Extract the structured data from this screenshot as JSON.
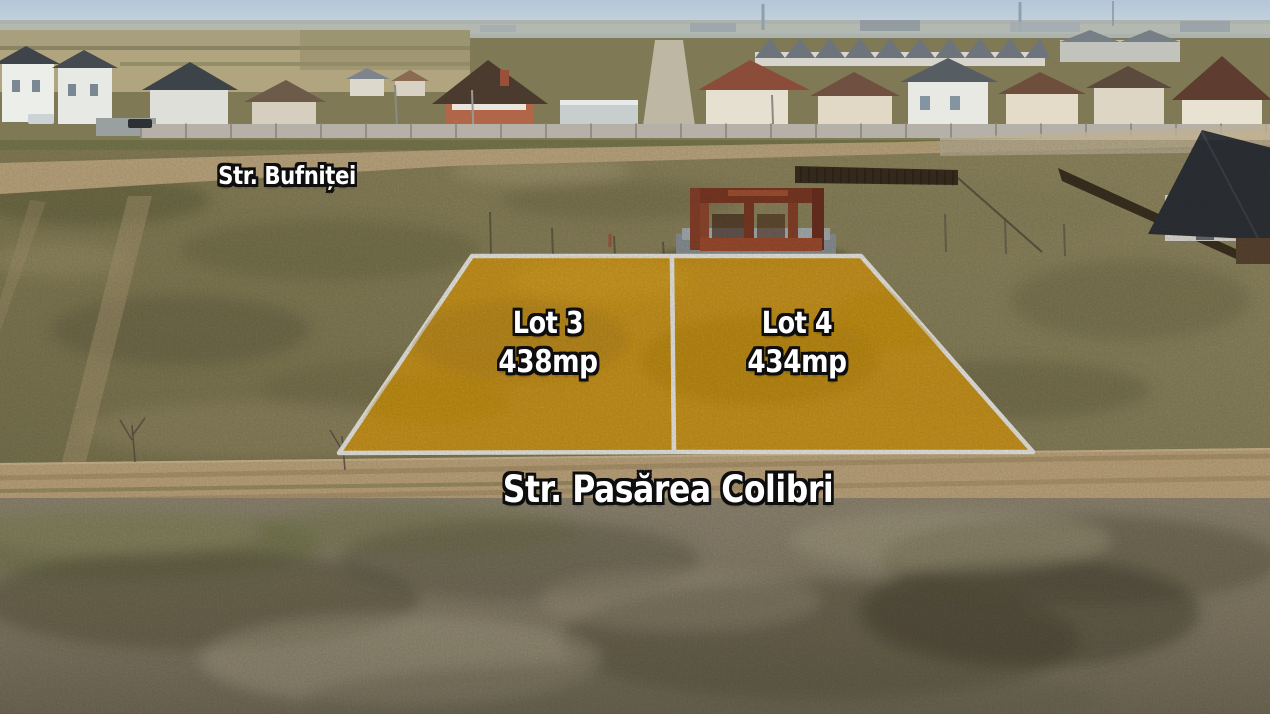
{
  "streets": {
    "top": "Str. Bufniței",
    "bottom": "Str. Pasărea Colibri"
  },
  "lots": [
    {
      "name": "Lot 3",
      "area": "438mp"
    },
    {
      "name": "Lot 4",
      "area": "434mp"
    }
  ],
  "colors": {
    "lot_highlight": "#d39a1b",
    "lot_border": "#efeee8",
    "label_text": "#ffffff",
    "label_outline": "#0e0e0e"
  }
}
